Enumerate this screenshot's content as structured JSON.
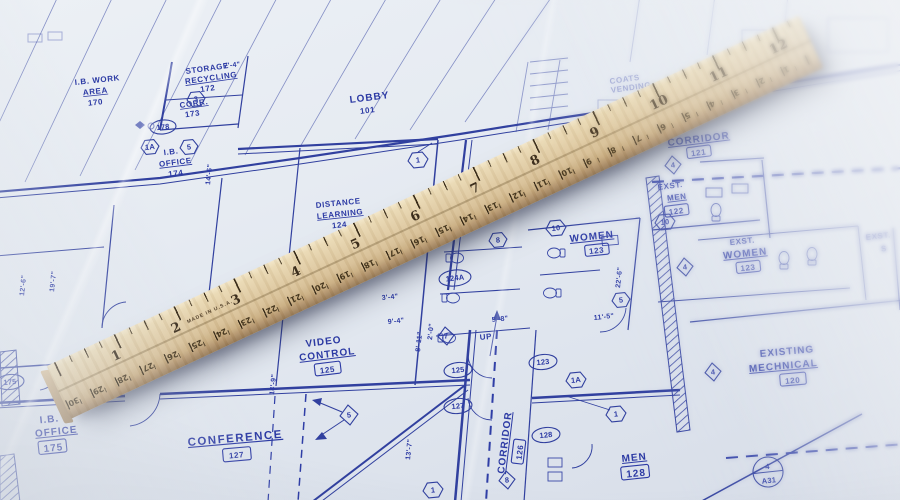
{
  "labels": {
    "ib_work_area": {
      "l1": "I.B. WORK",
      "l2": "AREA",
      "num": "170"
    },
    "storage": {
      "l1": "STORAGE",
      "l2": "RECYCLING",
      "num": "172"
    },
    "corr": {
      "l1": "CORR.",
      "num": "173"
    },
    "ib_office_upper": {
      "l1": "I.B.",
      "l2": "OFFICE",
      "num": "174"
    },
    "lobby": {
      "l1": "LOBBY",
      "num": "101"
    },
    "coats": {
      "l1": "COATS",
      "l2": "VENDING"
    },
    "corridor_upper": {
      "l1": "CORRIDOR",
      "num": "121"
    },
    "exst_men": {
      "l1": "EXST.",
      "l2": "MEN",
      "num": "122"
    },
    "exst_women": {
      "l1": "EXST.",
      "l2": "WOMEN",
      "num": "123"
    },
    "exst_s": {
      "l1": "EXST.",
      "l2": "S"
    },
    "distance_learning": {
      "l1": "DISTANCE",
      "l2": "LEARNING",
      "num": "124"
    },
    "women": {
      "l1": "WOMEN",
      "num": "123"
    },
    "video_control": {
      "l1": "VIDEO",
      "l2": "CONTROL",
      "num": "125"
    },
    "corridor_lower": {
      "l1": "CORRIDOR",
      "num": "126"
    },
    "conference": {
      "l1": "CONFERENCE",
      "num": "127"
    },
    "men": {
      "l1": "MEN",
      "num": "128"
    },
    "ib_office_lower": {
      "l1": "I.B.",
      "l2": "OFFICE",
      "num": "175"
    },
    "existing_mechanical": {
      "l1": "EXISTING",
      "l2": "MECHNICAL",
      "num": "120"
    },
    "up": "UP"
  },
  "dimensions": {
    "a": "12'-6\"",
    "b": "19'-7\"",
    "c": "14'-6\"",
    "d": "14'-9\"",
    "e": "8'-11\"",
    "f": "13'-7\"",
    "g": "2'-0\"",
    "h": "3'-4\"",
    "i": "9'-4\"",
    "j": "5'-8\"",
    "k": "11'-5\"",
    "l": "22'-6\"",
    "m": "7'-4\""
  },
  "tags": {
    "oval_178": "178",
    "oval_124a": "124A",
    "oval_125": "125",
    "oval_127": "127",
    "oval_123": "123",
    "oval_128": "128",
    "oval_175": "175",
    "hex_3": "3",
    "hex_1a_top": "1A",
    "hex_5_top": "5",
    "hex_1_lobby": "1",
    "hex_8": "8",
    "hex_10_women": "10",
    "hex_5_women": "5",
    "hex_10_men": "10",
    "hex_1a_corr": "1A",
    "hex_1_corr": "1",
    "hex_1_conf": "1",
    "dia_7": "7",
    "dia_5": "5",
    "dia_8": "8",
    "dia_4_a": "4",
    "dia_4_b": "4",
    "dia_4_c": "4",
    "detail_top": "4",
    "detail_bottom": "A31"
  },
  "ruler": {
    "inch_numbers": [
      "1",
      "2",
      "3",
      "4",
      "5",
      "6",
      "7",
      "8",
      "9",
      "10",
      "11",
      "12"
    ],
    "cm_numbers": [
      "30",
      "29",
      "28",
      "27",
      "26",
      "25",
      "24",
      "23",
      "22",
      "21",
      "20",
      "19",
      "18",
      "17",
      "16",
      "15",
      "14",
      "13",
      "12",
      "11",
      "10",
      "9",
      "8",
      "7",
      "6",
      "5",
      "4",
      "3",
      "2",
      "1"
    ],
    "made_in": "MADE IN U.S.A."
  }
}
